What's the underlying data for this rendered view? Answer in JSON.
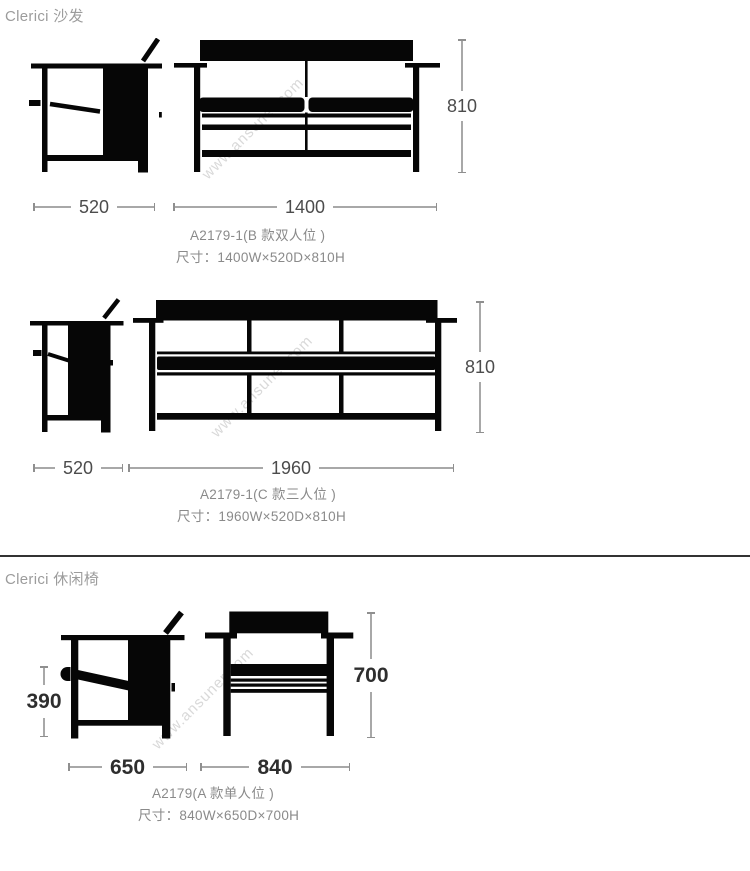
{
  "sections": [
    {
      "heading": "Clerici 沙发",
      "items": [
        {
          "model": "A2179-1(B 款双人位 )",
          "size": "尺寸：1400W×520D×810H",
          "dims": {
            "depth": "520",
            "width": "1400",
            "height": "810"
          }
        },
        {
          "model": "A2179-1(C 款三人位 )",
          "size": "尺寸：1960W×520D×810H",
          "dims": {
            "depth": "520",
            "width": "1960",
            "height": "810"
          }
        }
      ]
    },
    {
      "heading": "Clerici 休闲椅",
      "items": [
        {
          "model": "A2179(A 款单人位 )",
          "size": "尺寸：840W×650D×700H",
          "dims": {
            "depth": "650",
            "width": "840",
            "height": "700",
            "seat_height": "390"
          }
        }
      ]
    }
  ],
  "watermark": {
    "text": "www.ansuner.com"
  },
  "colors": {
    "background": "#ffffff",
    "drawing": "#060606",
    "dim_text": "#4c4c4c",
    "dim_text_bold": "#2e2e2e",
    "dim_line": "#a8a8a8",
    "label": "#8a8a8a",
    "heading": "#9c9c9c",
    "divider": "#333333",
    "watermark": "#d9d9d9"
  }
}
